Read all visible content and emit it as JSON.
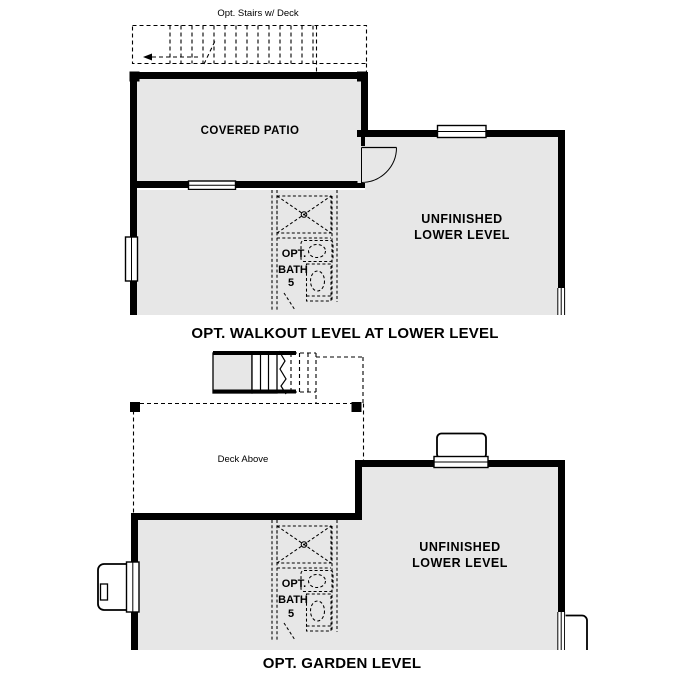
{
  "colors": {
    "floor": "#e7e7e7",
    "wall": "#000000",
    "line": "#000000",
    "background": "#ffffff"
  },
  "plans": {
    "walkout": {
      "stairs_label": "Opt. Stairs w/ Deck",
      "patio_label": "COVERED PATIO",
      "room_label_line1": "UNFINISHED",
      "room_label_line2": "LOWER LEVEL",
      "bath_label_line1": "OPT.",
      "bath_label_line2": "BATH",
      "bath_label_line3": "5",
      "title": "OPT. WALKOUT LEVEL AT LOWER LEVEL"
    },
    "garden": {
      "deck_label": "Deck Above",
      "room_label_line1": "UNFINISHED",
      "room_label_line2": "LOWER LEVEL",
      "bath_label_line1": "OPT.",
      "bath_label_line2": "BATH",
      "bath_label_line3": "5",
      "title": "OPT. GARDEN LEVEL"
    }
  }
}
